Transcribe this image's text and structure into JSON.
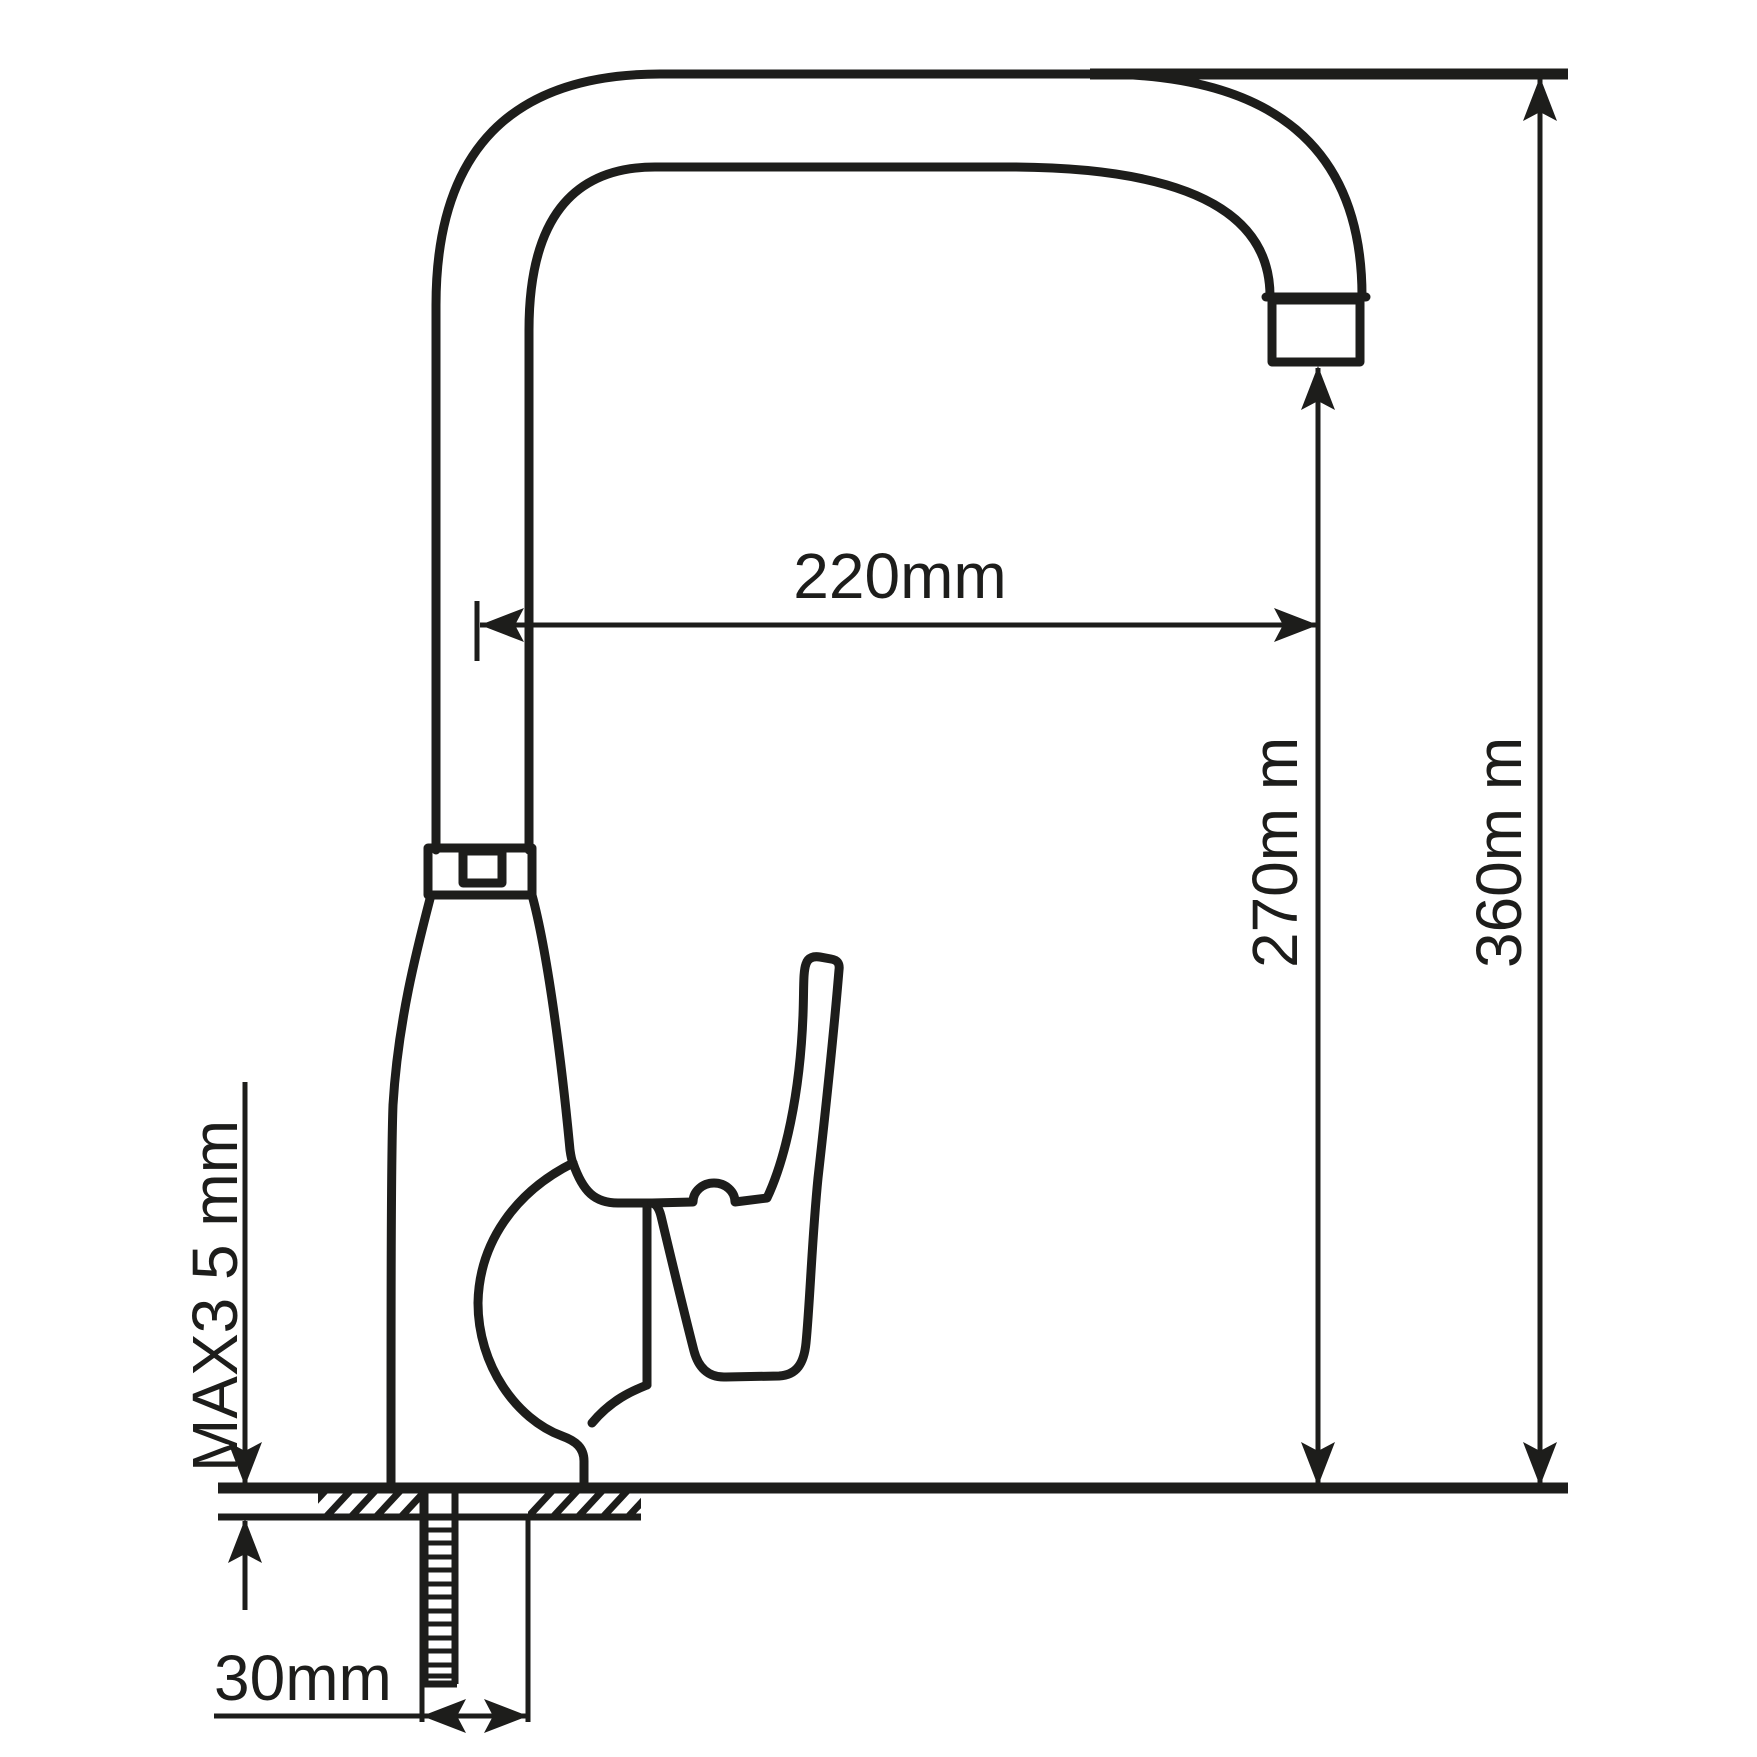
{
  "page": {
    "background_color": "#ffffff",
    "line_color": "#1d1d1b"
  },
  "drawing": {
    "type": "technical-dimension-diagram",
    "subject": "kitchen-faucet-side-view",
    "labels": {
      "spout_reach": "220mm",
      "spout_outlet_height": "270m m",
      "overall_height": "360m m",
      "max_counter_thickness": "MAX3 5 mm",
      "mounting_hole": "30mm"
    }
  }
}
